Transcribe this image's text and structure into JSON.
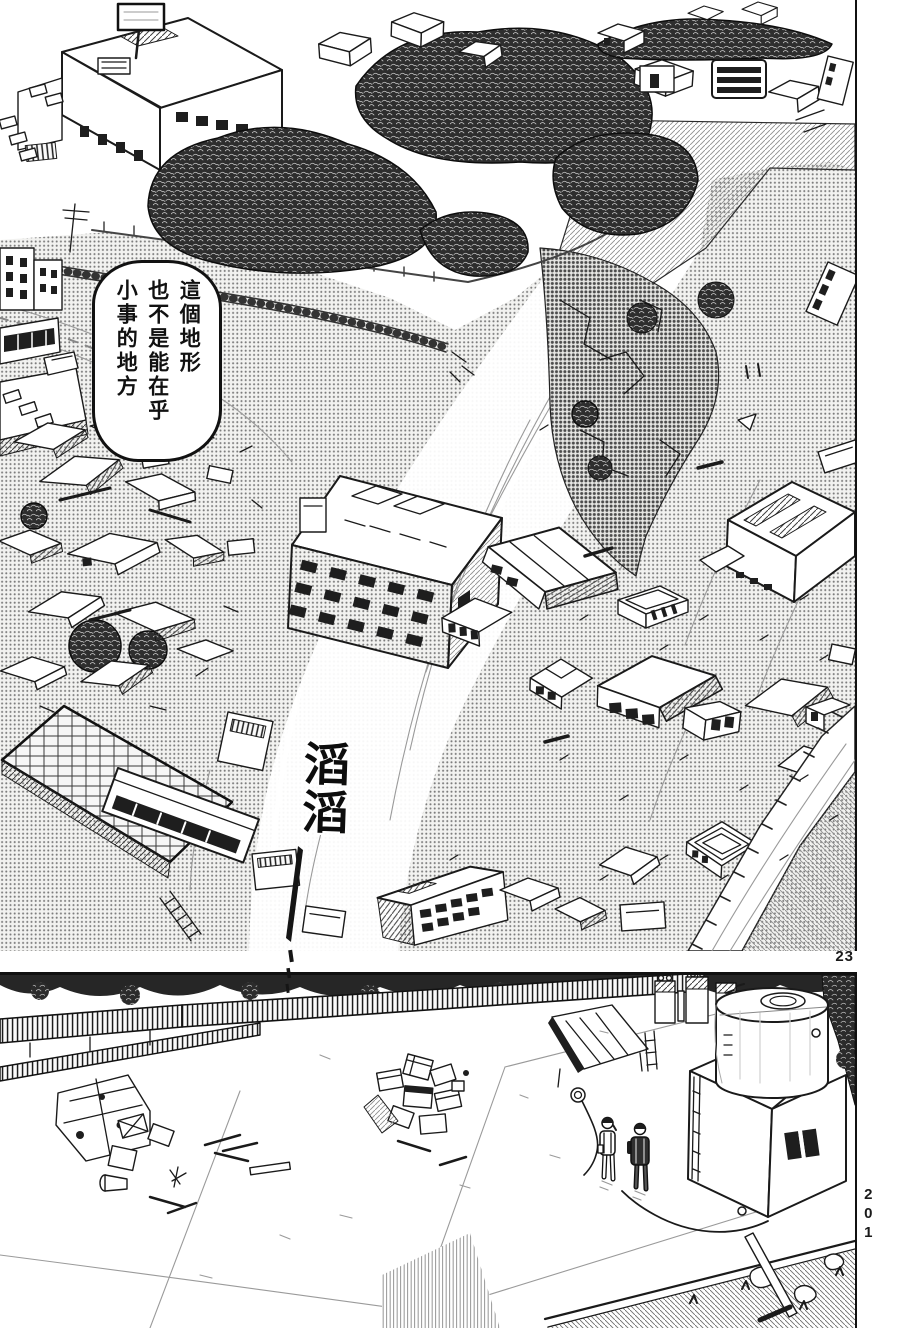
{
  "page": {
    "paper_color": "#ffffff",
    "ink_color": "#1a1a1a",
    "tone_color": "#c9c9c9",
    "panel_page_number": "23",
    "book_page_number": "201"
  },
  "top_panel": {
    "speech_bubble": {
      "lines": [
        "這個地形",
        "也不是能在乎",
        "小事的地方"
      ]
    },
    "sfx": "滔滔"
  }
}
